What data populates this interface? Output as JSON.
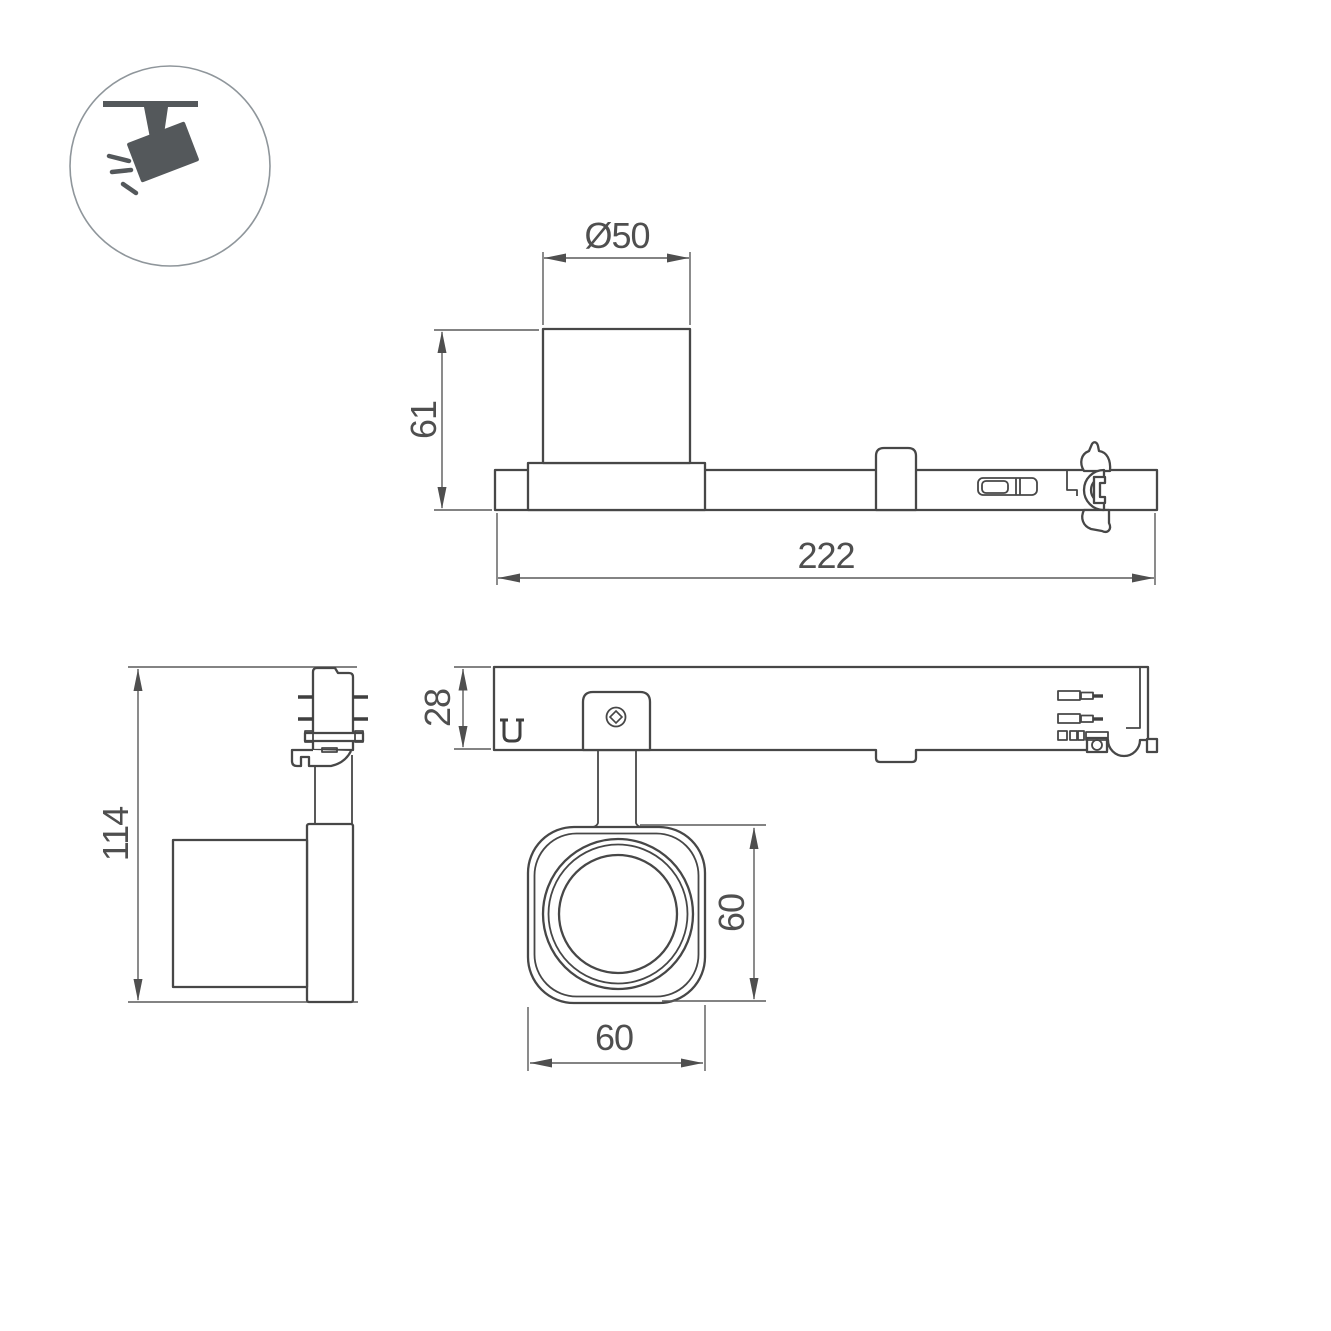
{
  "page": {
    "background": "#ffffff"
  },
  "icon": {
    "name": "track-spotlight-icon",
    "color": "#54585b",
    "ring_color": "#8f969b"
  },
  "colors": {
    "outline": "#474747",
    "dimension_lines": "#5a5a5a",
    "dimension_text": "#4f4f4f"
  },
  "views": {
    "side_elevation": {
      "dims": {
        "diameter": "Ø50",
        "height": "61",
        "length": "222"
      }
    },
    "plan": {
      "dims": {
        "height": "28"
      }
    },
    "side_profile": {
      "dims": {
        "height": "114"
      }
    },
    "front": {
      "dims": {
        "height": "60",
        "width": "60"
      }
    }
  }
}
